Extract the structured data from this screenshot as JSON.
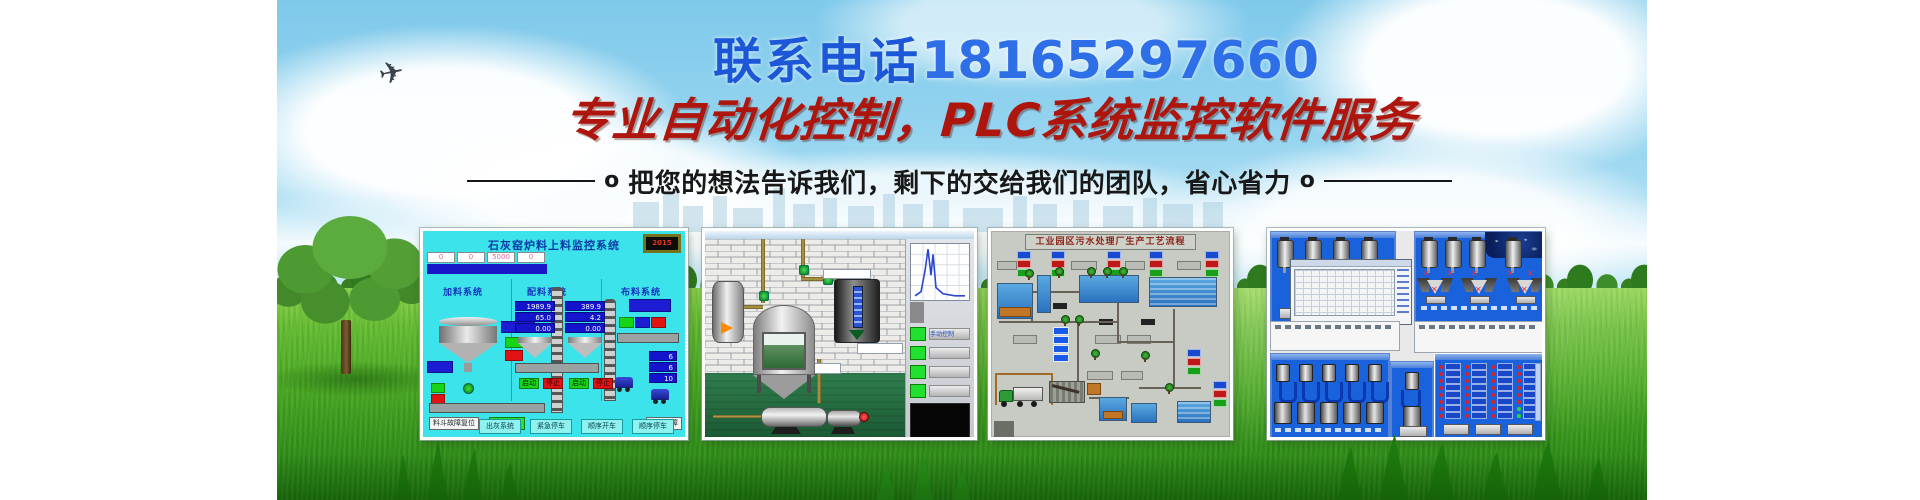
{
  "banner": {
    "phone_label": "联系电话",
    "phone_number": "18165297660",
    "headline": "专业自动化控制，PLC系统监控软件服务",
    "tagline": "把您的想法告诉我们，剩下的交给我们的团队，省心省力",
    "tagline_bullet": "o"
  },
  "colors": {
    "phone_blue": "#1c57d8",
    "headline_red": "#ae150c",
    "hmi_cyan": "#3ce3ea",
    "scada_blue": "#1a62dc",
    "grass_green": "#46a51f"
  },
  "screen1": {
    "title": "石灰窑炉料上料监控系统",
    "clock": "2015",
    "top_values": [
      "0",
      "0",
      "5000",
      "0"
    ],
    "sections": [
      "加料系统",
      "配料系统",
      "布料系统"
    ],
    "stack1": [
      "1989.9",
      "65.0",
      "0.00"
    ],
    "stack2": [
      "389.9",
      "4.2",
      "0.00"
    ],
    "stack3": [
      "6",
      "6",
      "10"
    ],
    "btn_start": "启动",
    "btn_stop": "停止",
    "btn_fault_reset": "料斗故障复位",
    "btn_debug": "启动调试",
    "label_feed_fault": "上料故障",
    "bottom_buttons": [
      "出灰系统",
      "紧急停车",
      "顺序开车",
      "顺序停车"
    ]
  },
  "screen2": {
    "panel_label": "手动控制"
  },
  "screen3": {
    "title": "工业园区污水处理厂生产工艺流程"
  }
}
